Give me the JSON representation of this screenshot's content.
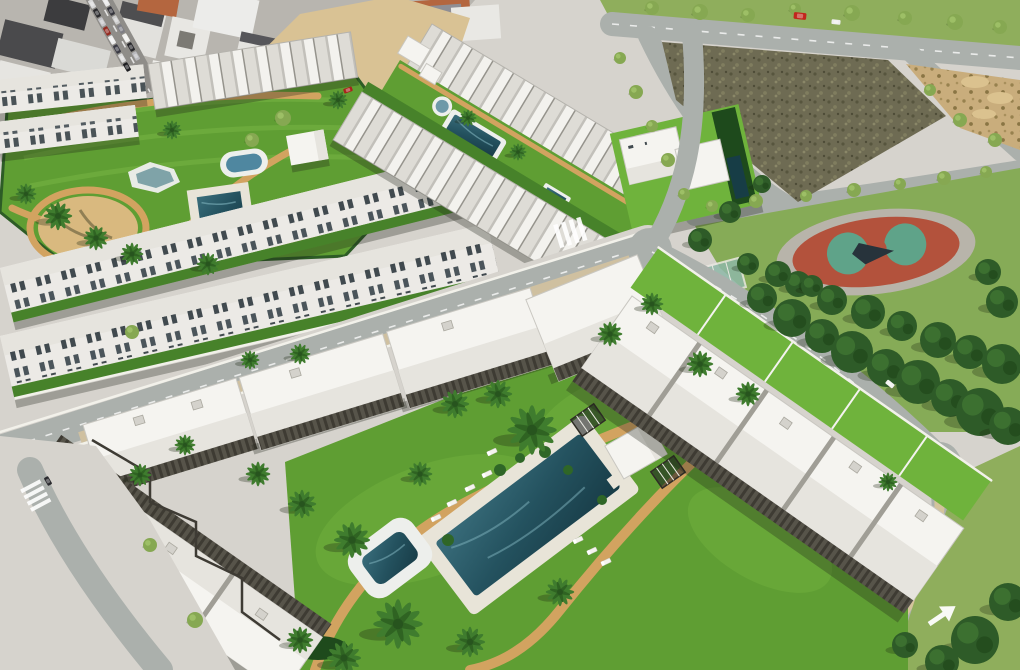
{
  "scene": {
    "kind": "aerial 3d render",
    "subject": "new-build residential resort complexes with white apartment blocks, communal gardens, swimming pools, palm trees, roads, an old town block, vacant dirt lots and a playground park"
  },
  "palette": {
    "grass": "#5f9e33",
    "grassBright": "#6fb33c",
    "grassPale": "#8fae5c",
    "grassDark": "#47822a",
    "roofWhite": "#f5f4f0",
    "roofShade": "#e6e4de",
    "wall": "#eceae6",
    "pavement": "#d6d3cd",
    "road": "#abb0ac",
    "sand": "#d9c294",
    "dirt": "#6e6b53",
    "path": "#d2a360",
    "poolDeep": "#24505c",
    "poolRim": "#edefec",
    "track": "#b3523c",
    "court": "#5fa389",
    "pine": "#2e5b28",
    "palm": "#3f7c2e",
    "pergola": "#4a473f",
    "hedge": "#1e4a1c",
    "terracotta": "#b4663f",
    "shadow": "rgba(30,32,22,0.30)"
  },
  "objects": {
    "palms": [
      {
        "x": 532,
        "y": 430,
        "s": 26
      },
      {
        "x": 498,
        "y": 394,
        "s": 15
      },
      {
        "x": 455,
        "y": 404,
        "s": 15
      },
      {
        "x": 420,
        "y": 474,
        "s": 13
      },
      {
        "x": 352,
        "y": 540,
        "s": 19
      },
      {
        "x": 302,
        "y": 504,
        "s": 15
      },
      {
        "x": 258,
        "y": 474,
        "s": 13
      },
      {
        "x": 398,
        "y": 624,
        "s": 26
      },
      {
        "x": 344,
        "y": 658,
        "s": 18
      },
      {
        "x": 300,
        "y": 640,
        "s": 14
      },
      {
        "x": 470,
        "y": 642,
        "s": 16
      },
      {
        "x": 560,
        "y": 592,
        "s": 15
      },
      {
        "x": 610,
        "y": 334,
        "s": 13
      },
      {
        "x": 652,
        "y": 304,
        "s": 12
      },
      {
        "x": 700,
        "y": 364,
        "s": 14
      },
      {
        "x": 748,
        "y": 394,
        "s": 13
      },
      {
        "x": 58,
        "y": 216,
        "s": 15
      },
      {
        "x": 96,
        "y": 238,
        "s": 13
      },
      {
        "x": 132,
        "y": 254,
        "s": 12
      },
      {
        "x": 26,
        "y": 194,
        "s": 11
      },
      {
        "x": 208,
        "y": 264,
        "s": 12
      },
      {
        "x": 172,
        "y": 130,
        "s": 10
      },
      {
        "x": 338,
        "y": 100,
        "s": 10
      },
      {
        "x": 300,
        "y": 354,
        "s": 11
      },
      {
        "x": 250,
        "y": 360,
        "s": 10
      },
      {
        "x": 888,
        "y": 482,
        "s": 10
      },
      {
        "x": 468,
        "y": 118,
        "s": 9
      },
      {
        "x": 518,
        "y": 152,
        "s": 9
      },
      {
        "x": 140,
        "y": 475,
        "s": 12
      },
      {
        "x": 185,
        "y": 445,
        "s": 11
      }
    ],
    "pines": [
      {
        "x": 762,
        "y": 298,
        "s": 15
      },
      {
        "x": 792,
        "y": 318,
        "s": 19
      },
      {
        "x": 822,
        "y": 336,
        "s": 17
      },
      {
        "x": 852,
        "y": 352,
        "s": 21
      },
      {
        "x": 886,
        "y": 368,
        "s": 19
      },
      {
        "x": 918,
        "y": 382,
        "s": 22
      },
      {
        "x": 950,
        "y": 398,
        "s": 19
      },
      {
        "x": 980,
        "y": 412,
        "s": 24
      },
      {
        "x": 1008,
        "y": 426,
        "s": 19
      },
      {
        "x": 798,
        "y": 284,
        "s": 13
      },
      {
        "x": 832,
        "y": 300,
        "s": 15
      },
      {
        "x": 868,
        "y": 312,
        "s": 17
      },
      {
        "x": 902,
        "y": 326,
        "s": 15
      },
      {
        "x": 938,
        "y": 340,
        "s": 18
      },
      {
        "x": 970,
        "y": 352,
        "s": 17
      },
      {
        "x": 1002,
        "y": 364,
        "s": 20
      },
      {
        "x": 748,
        "y": 264,
        "s": 11
      },
      {
        "x": 778,
        "y": 274,
        "s": 13
      },
      {
        "x": 812,
        "y": 286,
        "s": 11
      },
      {
        "x": 1002,
        "y": 302,
        "s": 16
      },
      {
        "x": 988,
        "y": 272,
        "s": 13
      },
      {
        "x": 975,
        "y": 640,
        "s": 24
      },
      {
        "x": 1008,
        "y": 602,
        "s": 19
      },
      {
        "x": 942,
        "y": 662,
        "s": 17
      },
      {
        "x": 905,
        "y": 645,
        "s": 13
      },
      {
        "x": 700,
        "y": 240,
        "s": 12
      },
      {
        "x": 730,
        "y": 212,
        "s": 11
      },
      {
        "x": 762,
        "y": 184,
        "s": 9
      }
    ],
    "shrubs": [
      {
        "x": 652,
        "y": 8,
        "s": 7
      },
      {
        "x": 700,
        "y": 12,
        "s": 8
      },
      {
        "x": 748,
        "y": 15,
        "s": 7
      },
      {
        "x": 795,
        "y": 9,
        "s": 6
      },
      {
        "x": 852,
        "y": 13,
        "s": 8
      },
      {
        "x": 905,
        "y": 18,
        "s": 7
      },
      {
        "x": 955,
        "y": 22,
        "s": 8
      },
      {
        "x": 1000,
        "y": 27,
        "s": 7
      },
      {
        "x": 620,
        "y": 58,
        "s": 6
      },
      {
        "x": 636,
        "y": 92,
        "s": 7
      },
      {
        "x": 652,
        "y": 126,
        "s": 6
      },
      {
        "x": 668,
        "y": 160,
        "s": 7
      },
      {
        "x": 684,
        "y": 194,
        "s": 6
      },
      {
        "x": 712,
        "y": 206,
        "s": 6
      },
      {
        "x": 756,
        "y": 201,
        "s": 7
      },
      {
        "x": 806,
        "y": 196,
        "s": 6
      },
      {
        "x": 854,
        "y": 190,
        "s": 7
      },
      {
        "x": 900,
        "y": 184,
        "s": 6
      },
      {
        "x": 944,
        "y": 178,
        "s": 7
      },
      {
        "x": 986,
        "y": 172,
        "s": 6
      },
      {
        "x": 283,
        "y": 118,
        "s": 8
      },
      {
        "x": 252,
        "y": 140,
        "s": 7
      },
      {
        "x": 960,
        "y": 120,
        "s": 7
      },
      {
        "x": 930,
        "y": 90,
        "s": 6
      },
      {
        "x": 995,
        "y": 140,
        "s": 7
      },
      {
        "x": 150,
        "y": 545,
        "s": 7
      },
      {
        "x": 195,
        "y": 620,
        "s": 8
      },
      {
        "x": 132,
        "y": 332,
        "s": 7
      }
    ],
    "cars": [
      {
        "x": 92,
        "y": 4,
        "r": 60,
        "c": "#d9d9d9"
      },
      {
        "x": 97,
        "y": 13,
        "r": 60,
        "c": "#2b2b2e"
      },
      {
        "x": 102,
        "y": 22,
        "r": 60,
        "c": "#c4c4c8"
      },
      {
        "x": 107,
        "y": 31,
        "r": 60,
        "c": "#932a21"
      },
      {
        "x": 112,
        "y": 40,
        "r": 60,
        "c": "#ededed"
      },
      {
        "x": 117,
        "y": 49,
        "r": 60,
        "c": "#3a3a44"
      },
      {
        "x": 122,
        "y": 58,
        "r": 60,
        "c": "#dadada"
      },
      {
        "x": 127,
        "y": 67,
        "r": 60,
        "c": "#1d1d20"
      },
      {
        "x": 106,
        "y": 2,
        "r": 60,
        "c": "#e8e8e8"
      },
      {
        "x": 111,
        "y": 11,
        "r": 60,
        "c": "#35353d"
      },
      {
        "x": 116,
        "y": 20,
        "r": 60,
        "c": "#cccccc"
      },
      {
        "x": 121,
        "y": 29,
        "r": 60,
        "c": "#7d7d84"
      },
      {
        "x": 126,
        "y": 38,
        "r": 60,
        "c": "#f0f0ee"
      },
      {
        "x": 131,
        "y": 47,
        "r": 60,
        "c": "#26262a"
      },
      {
        "x": 136,
        "y": 56,
        "r": 60,
        "c": "#b9b9bd"
      },
      {
        "x": 348,
        "y": 90,
        "r": -20,
        "c": "#a8241c"
      },
      {
        "x": 800,
        "y": 16,
        "r": 6,
        "c": "#c1271d",
        "s": 1.4
      },
      {
        "x": 836,
        "y": 22,
        "r": 6,
        "c": "#eeeeee"
      },
      {
        "x": 48,
        "y": 481,
        "r": 60,
        "c": "#2a2a2e"
      },
      {
        "x": 890,
        "y": 384,
        "r": 38,
        "c": "#f2f2f0"
      }
    ],
    "loungers": [
      {
        "x": 487,
        "y": 474,
        "r": -25
      },
      {
        "x": 470,
        "y": 488,
        "r": -25
      },
      {
        "x": 452,
        "y": 503,
        "r": -25
      },
      {
        "x": 436,
        "y": 518,
        "r": -25
      },
      {
        "x": 578,
        "y": 540,
        "r": -25
      },
      {
        "x": 592,
        "y": 551,
        "r": -25
      },
      {
        "x": 606,
        "y": 562,
        "r": -25
      },
      {
        "x": 492,
        "y": 452,
        "r": -25
      }
    ]
  }
}
